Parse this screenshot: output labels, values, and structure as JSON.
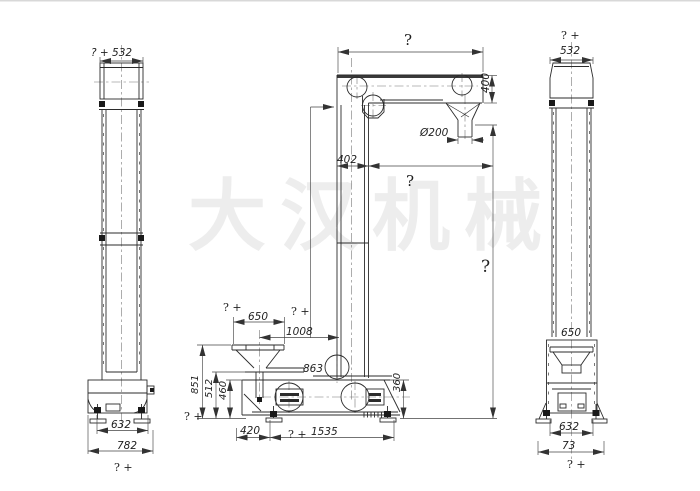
{
  "drawing": {
    "watermark": "大汉机械",
    "left_view": {
      "dim_top_width": "? + 532",
      "dim_boot_width": "632",
      "dim_base_width": "782",
      "dim_base_note": "? +"
    },
    "front_view": {
      "dim_head_width": "?",
      "dim_head_height": "400",
      "dim_outlet_diameter": "Ø200",
      "dim_casing_width": "402",
      "dim_head_overhang": "?",
      "dim_discharge_height": "?",
      "dim_hopper_note": "? +",
      "dim_hopper_width": "650",
      "dim_inlet_note": "? +",
      "dim_inlet_span": "1008",
      "dim_chute_height": "863",
      "dim_hopper_height": "851",
      "dim_hopper_height_note": "? +",
      "dim_plate_height": "512",
      "dim_boot_height": "460",
      "dim_tail_height": "360",
      "dim_foot_offset": "420",
      "dim_base_note": "? +",
      "dim_base_span": "1535"
    },
    "right_view": {
      "dim_top_note": "? +",
      "dim_top_width": "532",
      "dim_hopper_width": "650",
      "dim_boot_width": "632",
      "dim_base_width": "73",
      "dim_base_note": "? +"
    }
  }
}
